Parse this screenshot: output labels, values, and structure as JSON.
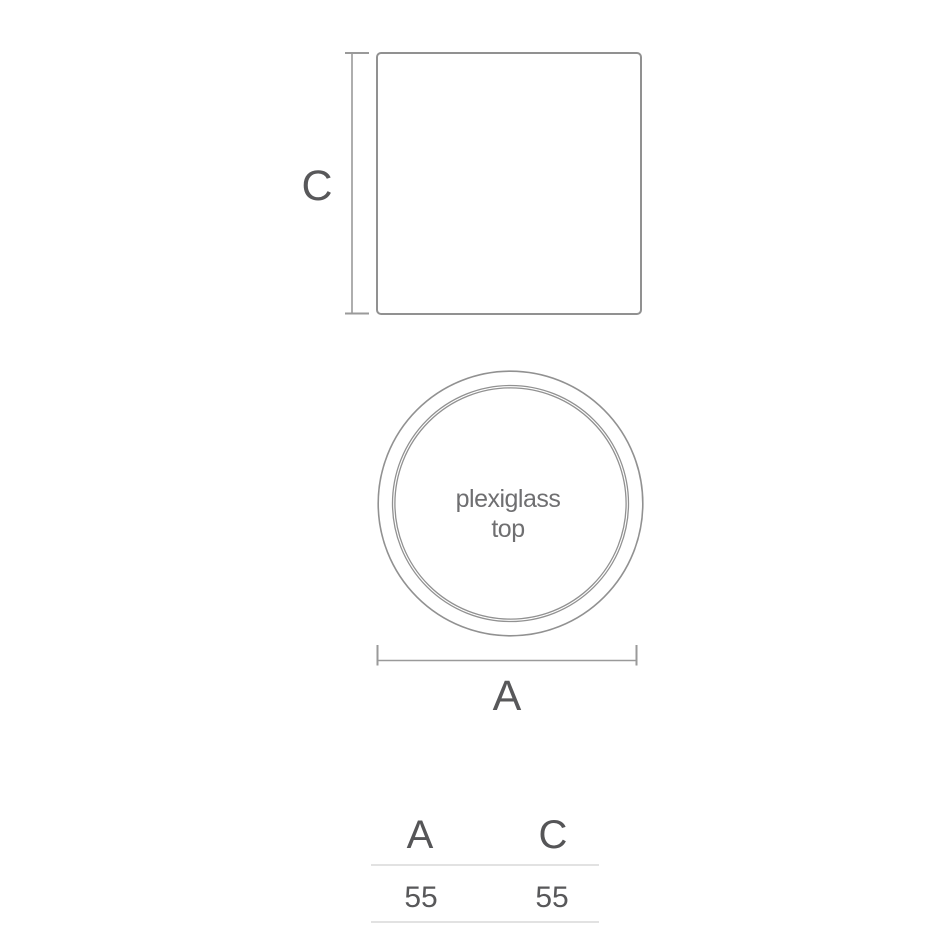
{
  "diagram": {
    "title": "plexiglass top dimension drawing",
    "side_view": {
      "dimension_label": "C"
    },
    "top_view": {
      "label_line1": "plexiglass",
      "label_line2": "top",
      "dimension_label": "A"
    },
    "dimensions_table": {
      "columns": [
        "A",
        "C"
      ],
      "values": [
        "55",
        "55"
      ]
    },
    "colors": {
      "background": "#ffffff",
      "outline_stroke": "#919191",
      "dimension_stroke": "#9a9a9a",
      "label_text": "#58585a",
      "annotation_text": "#6f6f71",
      "table_rule": "#e2e2e2"
    }
  }
}
